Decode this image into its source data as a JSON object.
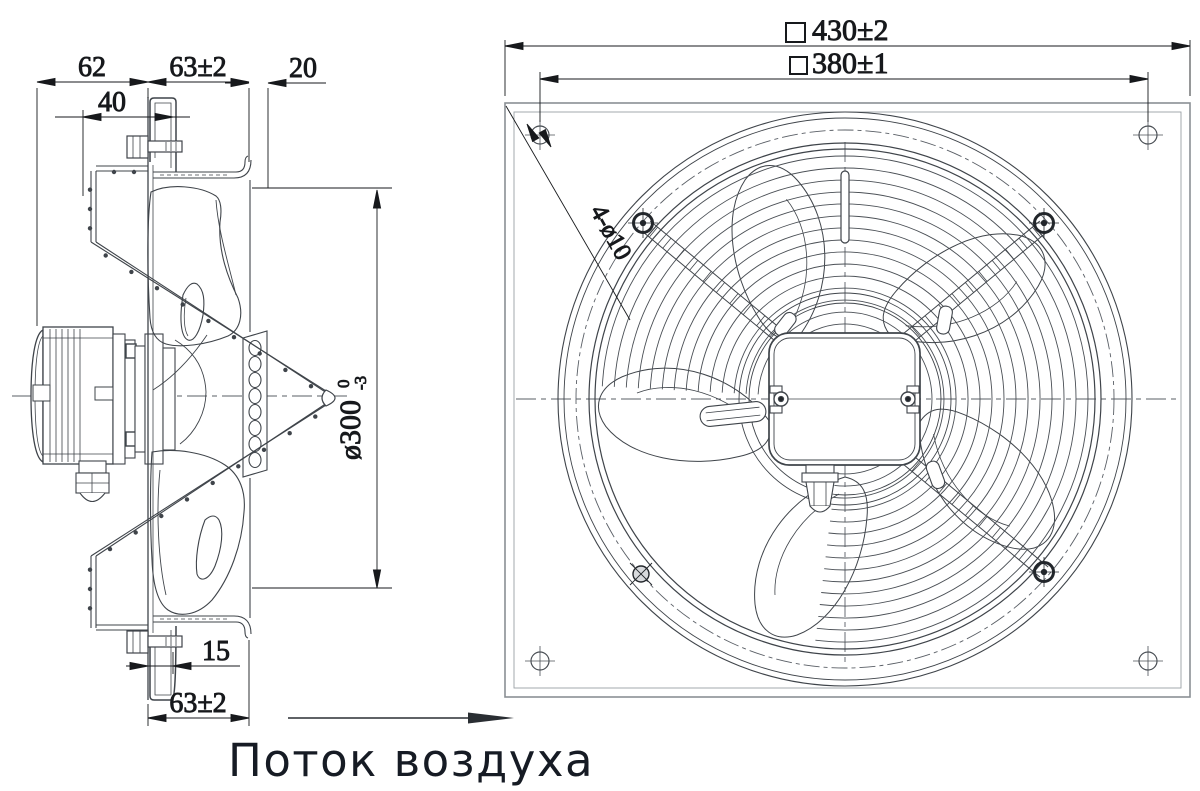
{
  "drawing": {
    "caption": {
      "airflow_label": "Поток воздуха"
    },
    "side_view": {
      "dims": {
        "motor_depth": "62",
        "flange_depth_top": "63±2",
        "lip_depth": "20",
        "bracket_offset": "40",
        "impeller_diameter": "ø300",
        "impeller_tol_upper": "0",
        "impeller_tol_lower": "-3",
        "bracket_depth": "15",
        "flange_depth_bottom": "63±2"
      }
    },
    "front_view": {
      "dims": {
        "panel_outer_size": "430±2",
        "panel_bolt_spacing": "380±1",
        "mounting_holes": "4-ø10"
      }
    }
  }
}
